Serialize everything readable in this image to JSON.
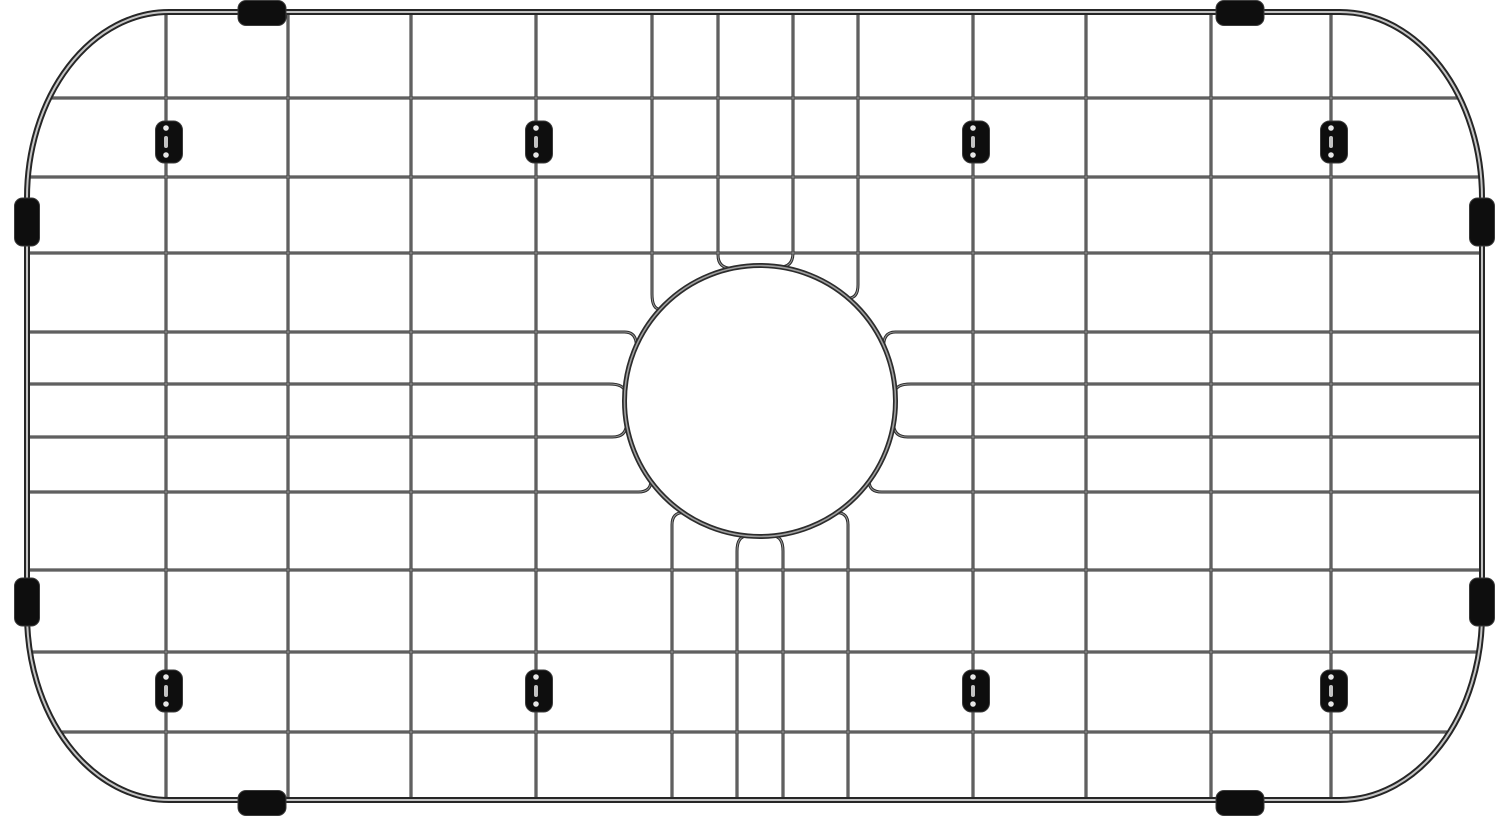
{
  "image": {
    "kind": "product-photo",
    "subject": "stainless-steel sink bottom grid with round center drain opening, black rubber edge bumpers and feet",
    "background": "#ffffff"
  },
  "canvas": {
    "width": 1499,
    "height": 817
  },
  "colors": {
    "wire": "#2c2c2c",
    "wire_highlight": "#ececec",
    "frame": "#262626",
    "rubber": "#0e0e0e",
    "rubber_highlight": "#3a3a3a",
    "background": "#ffffff"
  },
  "frame": {
    "left": 27,
    "top": 12,
    "right": 1482,
    "bottom": 800,
    "corner_rx": 142,
    "corner_ry": 186,
    "stroke": 6,
    "highlight_stroke": 2
  },
  "wires": {
    "stroke": 3,
    "highlight_stroke": 1,
    "verticals_full": [
      166,
      288,
      411,
      536,
      973,
      1086,
      1211,
      1331
    ],
    "verticals_cut_top": [
      652,
      718,
      793,
      858
    ],
    "verticals_cut_bottom": [
      672,
      737,
      783,
      848
    ],
    "horizontals_full": [
      98,
      177,
      253,
      570,
      652,
      732
    ],
    "horizontals_cut": [
      332,
      384,
      437,
      492
    ]
  },
  "opening": {
    "cx": 760,
    "cy": 401,
    "r": 135.5,
    "clear_r": 152,
    "ring_stroke": 5,
    "ring_highlight_stroke": 1.6
  },
  "bumpers": {
    "length_along_edge": 48,
    "thickness": 25,
    "corner_radius": 8,
    "top_x": [
      262,
      1240
    ],
    "bottom_x": [
      262,
      1240
    ],
    "left_y": [
      222,
      602
    ],
    "right_y": [
      222,
      602
    ]
  },
  "feet": {
    "wire_x": [
      166,
      536,
      973,
      1331
    ],
    "row_y": [
      142,
      691
    ],
    "width": 27,
    "height": 42,
    "corner_radius": 9,
    "x_offset": 3
  }
}
